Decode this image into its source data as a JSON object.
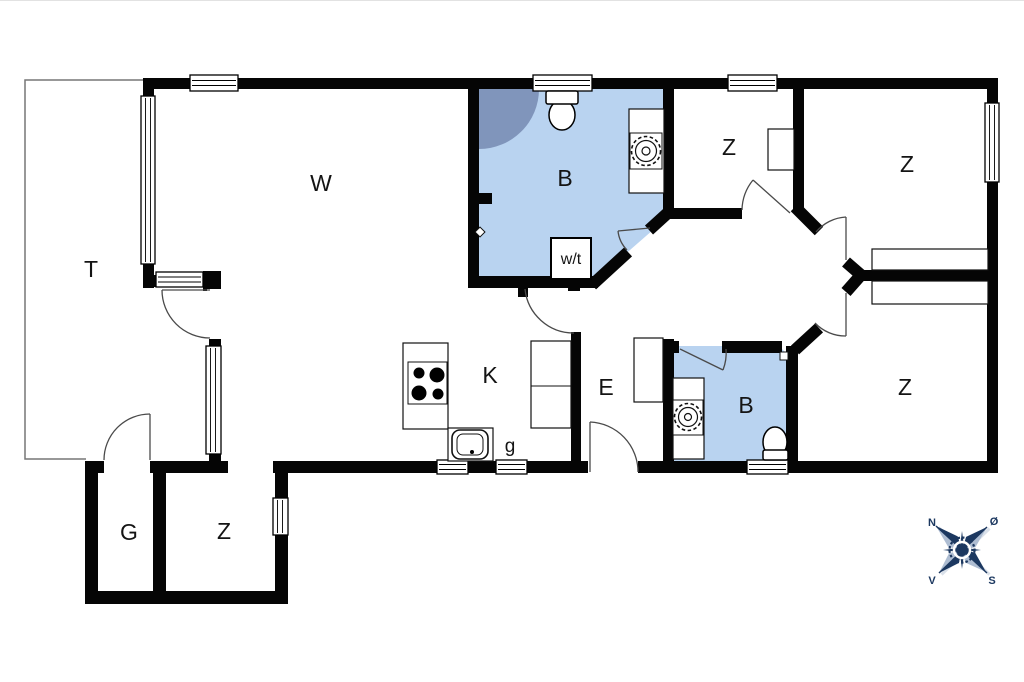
{
  "title": "Summerhouse floor plan",
  "rooms": {
    "terrace": "T",
    "living": "W",
    "bathroom_top": "B",
    "bedroom_mid": "Z",
    "bedroom_topright": "Z",
    "bedroom_bottomright": "Z",
    "kitchen": "K",
    "entrance": "E",
    "bathroom_bottom": "B",
    "annex_storage": "G",
    "annex_bedroom": "Z"
  },
  "fixtures": {
    "washer_dryer": "w/t",
    "pantry": "g"
  },
  "compass": {
    "north": "N",
    "east": "Ø",
    "south": "S",
    "west": "V"
  },
  "colors": {
    "wall": "#050505",
    "bathroom_fill": "#b9d3f0",
    "shower_fill": "#8095bb",
    "compass_navy": "#1c3860",
    "compass_light": "#aebdd2",
    "door_arc": "#4a4a4a",
    "terrace_line": "#777777",
    "background": "#ffffff"
  }
}
